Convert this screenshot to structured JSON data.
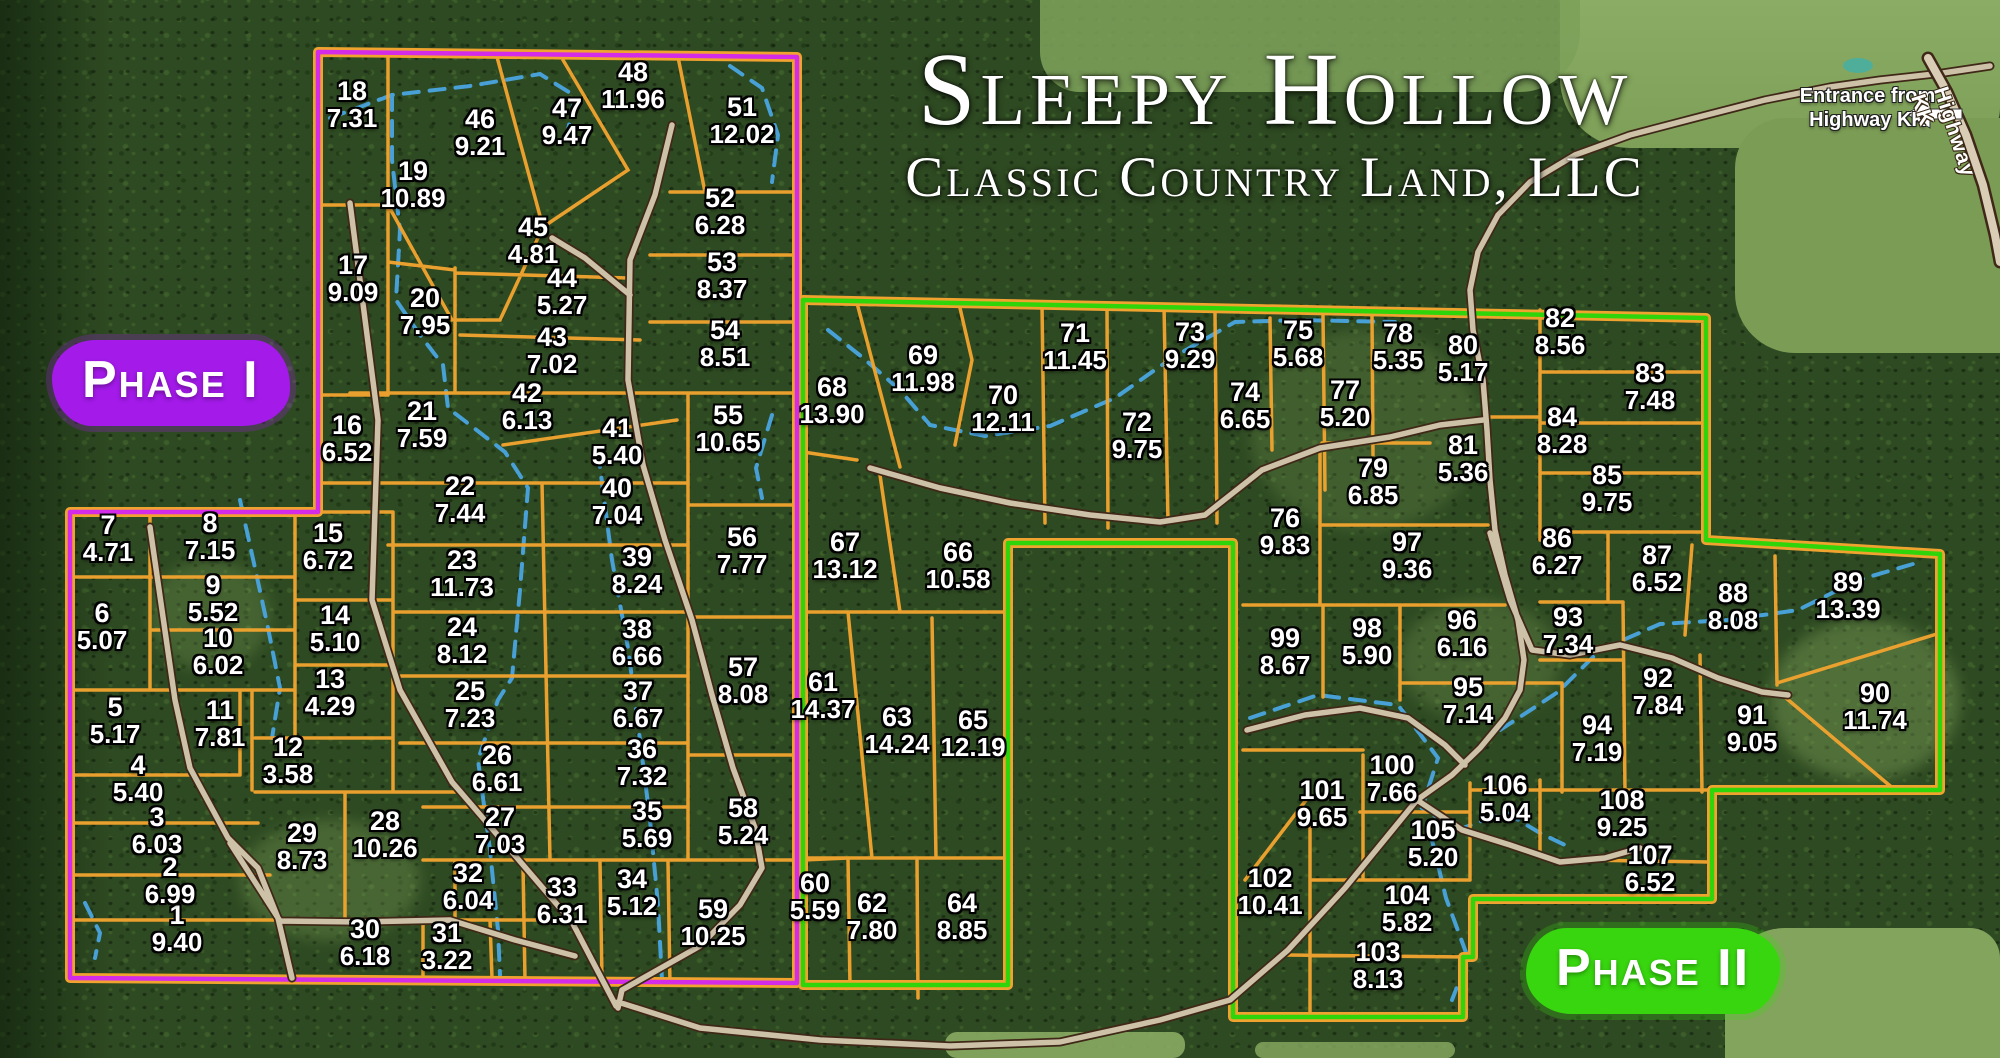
{
  "map": {
    "title_line1": "Sleepy Hollow",
    "title_line2": "Classic Country Land, LLC",
    "phase1_label": "Phase I",
    "phase2_label": "Phase II",
    "entrance_line1": "Entrance from",
    "entrance_line2": "Highway KK",
    "highway_label": "Highway KK",
    "colors": {
      "phase1_boundary": "#d42be8",
      "phase2_boundary": "#2fd50a",
      "lot_line": "#f0a32e",
      "road_fill": "#cdc1a8",
      "road_edge": "#3f2817",
      "stream": "#4aa5e0",
      "phase1_badge": "#a31ae9",
      "phase2_badge": "#38d60f"
    },
    "lots": [
      {
        "n": "1",
        "a": "9.40",
        "x": 177,
        "y": 930
      },
      {
        "n": "2",
        "a": "6.99",
        "x": 170,
        "y": 882
      },
      {
        "n": "3",
        "a": "6.03",
        "x": 157,
        "y": 832
      },
      {
        "n": "4",
        "a": "5.40",
        "x": 138,
        "y": 780
      },
      {
        "n": "5",
        "a": "5.17",
        "x": 115,
        "y": 722
      },
      {
        "n": "6",
        "a": "5.07",
        "x": 102,
        "y": 628
      },
      {
        "n": "7",
        "a": "4.71",
        "x": 108,
        "y": 540
      },
      {
        "n": "8",
        "a": "7.15",
        "x": 210,
        "y": 538
      },
      {
        "n": "9",
        "a": "5.52",
        "x": 213,
        "y": 600
      },
      {
        "n": "10",
        "a": "6.02",
        "x": 218,
        "y": 653
      },
      {
        "n": "11",
        "a": "7.81",
        "x": 220,
        "y": 725
      },
      {
        "n": "12",
        "a": "3.58",
        "x": 288,
        "y": 762
      },
      {
        "n": "13",
        "a": "4.29",
        "x": 330,
        "y": 694
      },
      {
        "n": "14",
        "a": "5.10",
        "x": 335,
        "y": 630
      },
      {
        "n": "15",
        "a": "6.72",
        "x": 328,
        "y": 548
      },
      {
        "n": "16",
        "a": "6.52",
        "x": 347,
        "y": 440
      },
      {
        "n": "17",
        "a": "9.09",
        "x": 353,
        "y": 280
      },
      {
        "n": "18",
        "a": "7.31",
        "x": 352,
        "y": 106
      },
      {
        "n": "19",
        "a": "10.89",
        "x": 413,
        "y": 186
      },
      {
        "n": "20",
        "a": "7.95",
        "x": 425,
        "y": 313
      },
      {
        "n": "21",
        "a": "7.59",
        "x": 422,
        "y": 426
      },
      {
        "n": "22",
        "a": "7.44",
        "x": 460,
        "y": 501
      },
      {
        "n": "23",
        "a": "11.73",
        "x": 462,
        "y": 575
      },
      {
        "n": "24",
        "a": "8.12",
        "x": 462,
        "y": 642
      },
      {
        "n": "25",
        "a": "7.23",
        "x": 470,
        "y": 706
      },
      {
        "n": "26",
        "a": "6.61",
        "x": 497,
        "y": 770
      },
      {
        "n": "27",
        "a": "7.03",
        "x": 500,
        "y": 832
      },
      {
        "n": "28",
        "a": "10.26",
        "x": 385,
        "y": 836
      },
      {
        "n": "29",
        "a": "8.73",
        "x": 302,
        "y": 848
      },
      {
        "n": "30",
        "a": "6.18",
        "x": 365,
        "y": 944
      },
      {
        "n": "31",
        "a": "3.22",
        "x": 447,
        "y": 948
      },
      {
        "n": "32",
        "a": "6.04",
        "x": 468,
        "y": 888
      },
      {
        "n": "33",
        "a": "6.31",
        "x": 562,
        "y": 902
      },
      {
        "n": "34",
        "a": "5.12",
        "x": 632,
        "y": 894
      },
      {
        "n": "35",
        "a": "5.69",
        "x": 647,
        "y": 826
      },
      {
        "n": "36",
        "a": "7.32",
        "x": 642,
        "y": 764
      },
      {
        "n": "37",
        "a": "6.67",
        "x": 638,
        "y": 706
      },
      {
        "n": "38",
        "a": "6.66",
        "x": 637,
        "y": 644
      },
      {
        "n": "39",
        "a": "8.24",
        "x": 637,
        "y": 572
      },
      {
        "n": "40",
        "a": "7.04",
        "x": 617,
        "y": 503
      },
      {
        "n": "41",
        "a": "5.40",
        "x": 617,
        "y": 443
      },
      {
        "n": "42",
        "a": "6.13",
        "x": 527,
        "y": 408
      },
      {
        "n": "43",
        "a": "7.02",
        "x": 552,
        "y": 352
      },
      {
        "n": "44",
        "a": "5.27",
        "x": 562,
        "y": 293
      },
      {
        "n": "45",
        "a": "4.81",
        "x": 533,
        "y": 242
      },
      {
        "n": "46",
        "a": "9.21",
        "x": 480,
        "y": 134
      },
      {
        "n": "47",
        "a": "9.47",
        "x": 567,
        "y": 123
      },
      {
        "n": "48",
        "a": "11.96",
        "x": 633,
        "y": 87
      },
      {
        "n": "51",
        "a": "12.02",
        "x": 742,
        "y": 122
      },
      {
        "n": "52",
        "a": "6.28",
        "x": 720,
        "y": 213
      },
      {
        "n": "53",
        "a": "8.37",
        "x": 722,
        "y": 277
      },
      {
        "n": "54",
        "a": "8.51",
        "x": 725,
        "y": 345
      },
      {
        "n": "55",
        "a": "10.65",
        "x": 728,
        "y": 430
      },
      {
        "n": "56",
        "a": "7.77",
        "x": 742,
        "y": 552
      },
      {
        "n": "57",
        "a": "8.08",
        "x": 743,
        "y": 682
      },
      {
        "n": "58",
        "a": "5.24",
        "x": 743,
        "y": 823
      },
      {
        "n": "59",
        "a": "10.25",
        "x": 713,
        "y": 924
      },
      {
        "n": "60",
        "a": "5.59",
        "x": 815,
        "y": 898
      },
      {
        "n": "61",
        "a": "14.37",
        "x": 823,
        "y": 697
      },
      {
        "n": "62",
        "a": "7.80",
        "x": 872,
        "y": 918
      },
      {
        "n": "63",
        "a": "14.24",
        "x": 897,
        "y": 732
      },
      {
        "n": "64",
        "a": "8.85",
        "x": 962,
        "y": 918
      },
      {
        "n": "65",
        "a": "12.19",
        "x": 973,
        "y": 735
      },
      {
        "n": "66",
        "a": "10.58",
        "x": 958,
        "y": 567
      },
      {
        "n": "67",
        "a": "13.12",
        "x": 845,
        "y": 557
      },
      {
        "n": "68",
        "a": "13.90",
        "x": 832,
        "y": 402
      },
      {
        "n": "69",
        "a": "11.98",
        "x": 923,
        "y": 370
      },
      {
        "n": "70",
        "a": "12.11",
        "x": 1003,
        "y": 410
      },
      {
        "n": "71",
        "a": "11.45",
        "x": 1075,
        "y": 348
      },
      {
        "n": "72",
        "a": "9.75",
        "x": 1137,
        "y": 437
      },
      {
        "n": "73",
        "a": "9.29",
        "x": 1190,
        "y": 347
      },
      {
        "n": "74",
        "a": "6.65",
        "x": 1245,
        "y": 407
      },
      {
        "n": "75",
        "a": "5.68",
        "x": 1298,
        "y": 345
      },
      {
        "n": "76",
        "a": "9.83",
        "x": 1285,
        "y": 533
      },
      {
        "n": "77",
        "a": "5.20",
        "x": 1345,
        "y": 405
      },
      {
        "n": "78",
        "a": "5.35",
        "x": 1398,
        "y": 348
      },
      {
        "n": "79",
        "a": "6.85",
        "x": 1373,
        "y": 483
      },
      {
        "n": "80",
        "a": "5.17",
        "x": 1463,
        "y": 360
      },
      {
        "n": "81",
        "a": "5.36",
        "x": 1463,
        "y": 460
      },
      {
        "n": "82",
        "a": "8.56",
        "x": 1560,
        "y": 333
      },
      {
        "n": "83",
        "a": "7.48",
        "x": 1650,
        "y": 388
      },
      {
        "n": "84",
        "a": "8.28",
        "x": 1562,
        "y": 432
      },
      {
        "n": "85",
        "a": "9.75",
        "x": 1607,
        "y": 490
      },
      {
        "n": "86",
        "a": "6.27",
        "x": 1557,
        "y": 553
      },
      {
        "n": "87",
        "a": "6.52",
        "x": 1657,
        "y": 570
      },
      {
        "n": "88",
        "a": "8.08",
        "x": 1733,
        "y": 608
      },
      {
        "n": "89",
        "a": "13.39",
        "x": 1848,
        "y": 597
      },
      {
        "n": "90",
        "a": "11.74",
        "x": 1875,
        "y": 708
      },
      {
        "n": "91",
        "a": "9.05",
        "x": 1752,
        "y": 730
      },
      {
        "n": "92",
        "a": "7.84",
        "x": 1658,
        "y": 693
      },
      {
        "n": "93",
        "a": "7.34",
        "x": 1568,
        "y": 632
      },
      {
        "n": "94",
        "a": "7.19",
        "x": 1597,
        "y": 740
      },
      {
        "n": "95",
        "a": "7.14",
        "x": 1468,
        "y": 702
      },
      {
        "n": "96",
        "a": "6.16",
        "x": 1462,
        "y": 635
      },
      {
        "n": "97",
        "a": "9.36",
        "x": 1407,
        "y": 557
      },
      {
        "n": "98",
        "a": "5.90",
        "x": 1367,
        "y": 643
      },
      {
        "n": "99",
        "a": "8.67",
        "x": 1285,
        "y": 653
      },
      {
        "n": "100",
        "a": "7.66",
        "x": 1392,
        "y": 780
      },
      {
        "n": "101",
        "a": "9.65",
        "x": 1322,
        "y": 805
      },
      {
        "n": "102",
        "a": "10.41",
        "x": 1270,
        "y": 893
      },
      {
        "n": "103",
        "a": "8.13",
        "x": 1378,
        "y": 967
      },
      {
        "n": "104",
        "a": "5.82",
        "x": 1407,
        "y": 910
      },
      {
        "n": "105",
        "a": "5.20",
        "x": 1433,
        "y": 845
      },
      {
        "n": "106",
        "a": "5.04",
        "x": 1505,
        "y": 800
      },
      {
        "n": "107",
        "a": "6.52",
        "x": 1650,
        "y": 870
      },
      {
        "n": "108",
        "a": "9.25",
        "x": 1622,
        "y": 815
      }
    ]
  }
}
